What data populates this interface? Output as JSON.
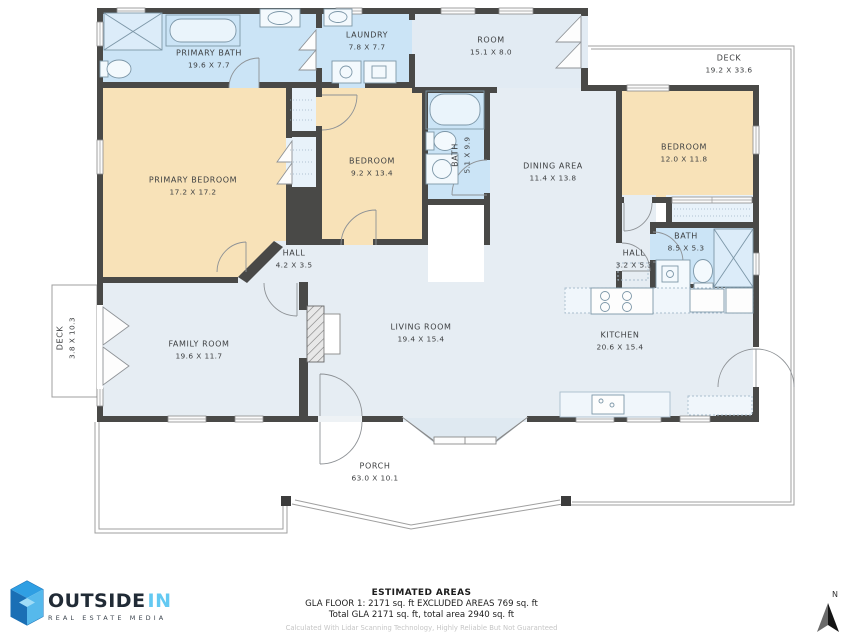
{
  "plan": {
    "rooms": [
      {
        "id": "primary-bath",
        "name": "PRIMARY BATH",
        "dims": "19.6 X 7.7"
      },
      {
        "id": "laundry",
        "name": "LAUNDRY",
        "dims": "7.8 X 7.7"
      },
      {
        "id": "room",
        "name": "ROOM",
        "dims": "15.1 X 8.0"
      },
      {
        "id": "deck-right",
        "name": "DECK",
        "dims": "19.2 X 33.6"
      },
      {
        "id": "primary-bedroom",
        "name": "PRIMARY BEDROOM",
        "dims": "17.2 X 17.2"
      },
      {
        "id": "bedroom-middle",
        "name": "BEDROOM",
        "dims": "9.2 X 13.4"
      },
      {
        "id": "bath-middle",
        "name": "BATH",
        "dims": "5.1 X 9.9"
      },
      {
        "id": "dining-area",
        "name": "DINING AREA",
        "dims": "11.4 X 13.8"
      },
      {
        "id": "bedroom-right",
        "name": "BEDROOM",
        "dims": "12.0 X 11.8"
      },
      {
        "id": "bath-right",
        "name": "BATH",
        "dims": "8.5 X 5.3"
      },
      {
        "id": "hall-right",
        "name": "HALL",
        "dims": "3.2 X 5.3"
      },
      {
        "id": "hall-center",
        "name": "HALL",
        "dims": "4.2 X 3.5"
      },
      {
        "id": "deck-left",
        "name": "DECK",
        "dims": "3.8 X 10.3"
      },
      {
        "id": "family-room",
        "name": "FAMILY ROOM",
        "dims": "19.6 X 11.7"
      },
      {
        "id": "living-room",
        "name": "LIVING ROOM",
        "dims": "19.4 X 15.4"
      },
      {
        "id": "kitchen",
        "name": "KITCHEN",
        "dims": "20.6 X 15.4"
      },
      {
        "id": "porch",
        "name": "PORCH",
        "dims": "63.0 X 10.1"
      }
    ],
    "compass": {
      "label": "N"
    }
  },
  "footer": {
    "areas_title": "ESTIMATED AREAS",
    "areas_line1": "GLA FLOOR 1: 2171 sq. ft EXCLUDED AREAS 769 sq. ft",
    "areas_line2": "Total GLA 2171 sq. ft, total area 2940 sq. ft",
    "disclaimer": "Calculated With Lidar Scanning Technology, Highly Reliable But Not Guaranteed",
    "logo": {
      "brand_primary": "OUTSIDE",
      "brand_accent": "IN",
      "tagline": "REAL ESTATE MEDIA"
    }
  },
  "colors": {
    "wall": "#494947",
    "bedroom_fill": "#f8e2b8",
    "bath_fill": "#cbe4f6",
    "living_fill": "#e6edf3",
    "closet_fill": "#e8f2fa",
    "outline_gray": "#9f9f9f",
    "logo_blue": "#63c9f2",
    "logo_dark": "#212b36"
  }
}
